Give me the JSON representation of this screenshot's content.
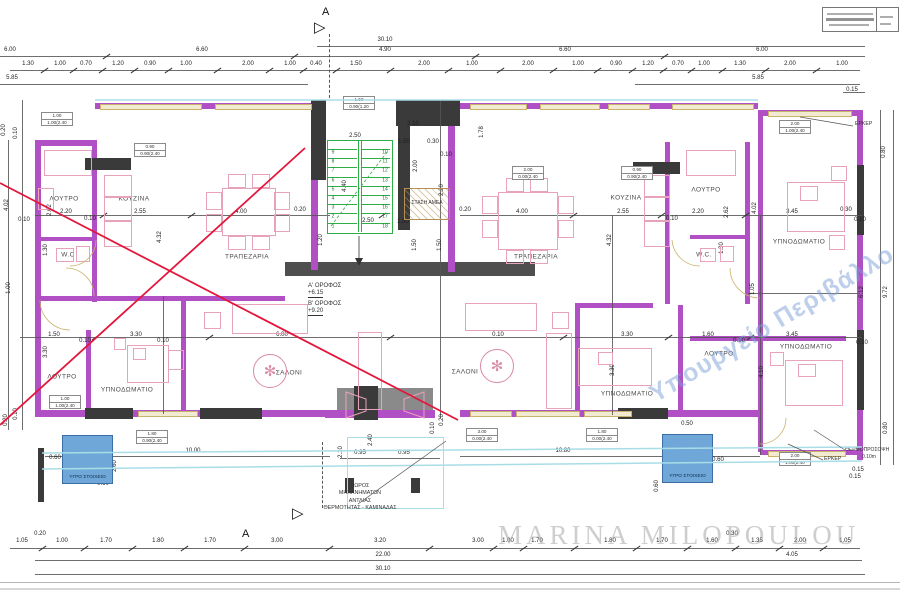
{
  "canvas": {
    "w": 900,
    "h": 600
  },
  "colors": {
    "wall": "#b050c4",
    "wall_dark": "#3a3a3a",
    "band": "#4f4f4f",
    "window": "#f3ead2",
    "window_edge": "#c9b269",
    "cyan": "#a8dde6",
    "dim": "#333333",
    "furn": "#e8a2ba",
    "stair": "#2fae47",
    "red": "#e3173c",
    "blue_fill": "#6fa8d8",
    "blue_edge": "#3b6ea5",
    "gray": "#8a8a8a",
    "hatch": "#b49055"
  },
  "header": {
    "section_letter": "A"
  },
  "watermark": {
    "text": "MARINA MILOPOULOU"
  },
  "stamp": {
    "text": "Υπουργείο Περιβάλλο"
  },
  "levels": {
    "l1": "Α' ΟΡΟΦΟΣ",
    "e1": "+6.15",
    "l2": "Β' ΟΡΟΦΟΣ",
    "e2": "+9.20"
  },
  "labels": {
    "wet": "ΥΓΡΟ ΣΤΟΙΧΕΙΟ",
    "amea": "ΣΤΑΣΗ ΑΜΕΑ",
    "erker": "ΕΡΚΕΡ",
    "thermo": "ΘΕΡΜΟΠΡΟΣΟΨΗ",
    "thermo_val": "0.10m",
    "m1": "ΧΩΡΟΣ",
    "m2": "ΜΗΧΑΝΗΜΑΤΩΝ",
    "m3": "ΑΝΤΛΙΑΣ",
    "m4": "ΘΕΡΜΟΤΗΤΑΣ - ΚΑΜΙΝΑΔΑΣ"
  },
  "rooms": [
    [
      "ΛΟΥΤΡΟ",
      64,
      199
    ],
    [
      "ΚΟΥΖΙΝΑ",
      134,
      199
    ],
    [
      "W.C",
      68,
      255
    ],
    [
      "ΤΡΑΠΕΖΑΡΙΑ",
      247,
      257
    ],
    [
      "ΛΟΥΤΡΟ",
      62,
      377
    ],
    [
      "ΥΠΝΟΔΩΜΑΤΙΟ",
      127,
      390
    ],
    [
      "ΣΑΛΟΝΙ",
      289,
      373
    ],
    [
      "ΣΑΛΟΝΙ",
      465,
      372
    ],
    [
      "ΤΡΑΠΕΖΑΡΙΑ",
      536,
      257
    ],
    [
      "ΚΟΥΖΙΝΑ",
      626,
      198
    ],
    [
      "ΛΟΥΤΡΟ",
      706,
      190
    ],
    [
      "W.C.",
      704,
      255
    ],
    [
      "ΥΠΝΟΔΩΜΑΤΙΟ",
      627,
      394
    ],
    [
      "ΛΟΥΤΡΟ",
      719,
      354
    ],
    [
      "ΥΠΝΟΔΩΜΑΤΙΟ",
      799,
      242
    ],
    [
      "ΥΠΝΟΔΩΜΑΤΙΟ",
      806,
      347
    ]
  ],
  "dims": [
    [
      "30.10",
      385,
      40
    ],
    [
      "6.00",
      10,
      50
    ],
    [
      "6.60",
      202,
      50
    ],
    [
      "4.90",
      385,
      50
    ],
    [
      "6.60",
      565,
      50
    ],
    [
      "6.00",
      762,
      50
    ],
    [
      "1.30",
      28,
      64
    ],
    [
      "1.00",
      60,
      64
    ],
    [
      "0.70",
      86,
      64
    ],
    [
      "1.20",
      118,
      64
    ],
    [
      "0.90",
      150,
      64
    ],
    [
      "1.00",
      186,
      64
    ],
    [
      "2.00",
      248,
      64
    ],
    [
      "1.00",
      290,
      64
    ],
    [
      "0.40",
      316,
      64
    ],
    [
      "1.50",
      356,
      64
    ],
    [
      "2.00",
      424,
      64
    ],
    [
      "1.00",
      472,
      64
    ],
    [
      "2.00",
      528,
      64
    ],
    [
      "1.00",
      578,
      64
    ],
    [
      "0.90",
      616,
      64
    ],
    [
      "1.20",
      648,
      64
    ],
    [
      "0.70",
      678,
      64
    ],
    [
      "1.00",
      704,
      64
    ],
    [
      "1.30",
      740,
      64
    ],
    [
      "2.00",
      790,
      64
    ],
    [
      "1.00",
      842,
      64
    ],
    [
      "5.85",
      12,
      78
    ],
    [
      "5.85",
      758,
      78
    ],
    [
      "0.15",
      852,
      90
    ],
    [
      "0.20",
      4,
      130,
      1
    ],
    [
      "0.10",
      16,
      133,
      1
    ],
    [
      "4.02",
      7,
      205,
      1
    ],
    [
      "2.62",
      50,
      210,
      1
    ],
    [
      "0.10",
      24,
      220
    ],
    [
      "1.30",
      46,
      250,
      1
    ],
    [
      "1.00",
      9,
      288,
      1
    ],
    [
      "3.30",
      46,
      352,
      1
    ],
    [
      "0.20",
      6,
      420,
      1
    ],
    [
      "0.10",
      16,
      414,
      1
    ],
    [
      "0.80",
      884,
      152,
      1
    ],
    [
      "6.12",
      862,
      292,
      1
    ],
    [
      "9.72",
      886,
      292,
      1
    ],
    [
      "0.80",
      886,
      428,
      1
    ],
    [
      "0.15",
      858,
      470
    ],
    [
      "2.20",
      66,
      212
    ],
    [
      "0.10",
      90,
      219
    ],
    [
      "2.55",
      140,
      212
    ],
    [
      "4.00",
      241,
      212
    ],
    [
      "0.20",
      300,
      210
    ],
    [
      "0.20",
      465,
      210
    ],
    [
      "4.00",
      522,
      212
    ],
    [
      "2.55",
      623,
      212
    ],
    [
      "0.10",
      672,
      219
    ],
    [
      "2.20",
      698,
      212
    ],
    [
      "3.45",
      792,
      212
    ],
    [
      "0.30",
      846,
      210
    ],
    [
      "0.10",
      860,
      220
    ],
    [
      "4.32",
      160,
      237,
      1
    ],
    [
      "4.32",
      610,
      240,
      1
    ],
    [
      "2.62",
      727,
      212,
      1
    ],
    [
      "4.02",
      755,
      208,
      1
    ],
    [
      "2.50",
      355,
      136
    ],
    [
      "2.10",
      413,
      124
    ],
    [
      "1.50",
      404,
      142
    ],
    [
      "0.30",
      433,
      142
    ],
    [
      "0.10",
      446,
      155
    ],
    [
      "1.78",
      482,
      132,
      1
    ],
    [
      "2.00",
      416,
      166,
      1
    ],
    [
      "2.20",
      442,
      190,
      1
    ],
    [
      "1.80",
      403,
      222
    ],
    [
      "1.50",
      415,
      245,
      1
    ],
    [
      "1.50",
      440,
      245,
      1
    ],
    [
      "2.50",
      368,
      221
    ],
    [
      "4.40",
      345,
      186,
      1
    ],
    [
      "1.20",
      321,
      240,
      1
    ],
    [
      "1.50",
      54,
      335
    ],
    [
      "0.10",
      85,
      341
    ],
    [
      "3.30",
      136,
      335
    ],
    [
      "0.10",
      163,
      341
    ],
    [
      "6.00",
      282,
      335
    ],
    [
      "0.10",
      498,
      335
    ],
    [
      "3.30",
      627,
      335
    ],
    [
      "1.60",
      708,
      335
    ],
    [
      "0.10",
      739,
      341
    ],
    [
      "3.45",
      792,
      335
    ],
    [
      "0.10",
      862,
      343
    ],
    [
      "3.30",
      613,
      370,
      1
    ],
    [
      "4.10",
      762,
      372,
      1
    ],
    [
      "1.05",
      753,
      289,
      1
    ],
    [
      "1.30",
      722,
      248,
      1
    ],
    [
      "10.00",
      193,
      451
    ],
    [
      "10.80",
      563,
      451
    ],
    [
      "0.95",
      360,
      453
    ],
    [
      "0.95",
      404,
      453
    ],
    [
      "2.10",
      341,
      452,
      1
    ],
    [
      "2.40",
      371,
      440,
      1
    ],
    [
      "0.60",
      55,
      458
    ],
    [
      "2.60",
      115,
      466,
      1
    ],
    [
      "0.60",
      103,
      484
    ],
    [
      "0.50",
      687,
      424
    ],
    [
      "0.60",
      718,
      460
    ],
    [
      "0.60",
      657,
      486,
      1
    ],
    [
      "3.90",
      788,
      465
    ],
    [
      "0.15",
      855,
      477
    ],
    [
      "0.10",
      433,
      428,
      1
    ],
    [
      "0.20",
      442,
      420,
      1
    ],
    [
      "1.05",
      22,
      541
    ],
    [
      "0.20",
      40,
      534
    ],
    [
      "1.00",
      62,
      541
    ],
    [
      "1.70",
      106,
      541
    ],
    [
      "1.80",
      158,
      541
    ],
    [
      "1.70",
      210,
      541
    ],
    [
      "3.00",
      277,
      541
    ],
    [
      "3.20",
      380,
      541
    ],
    [
      "3.00",
      478,
      541
    ],
    [
      "1.00",
      508,
      541
    ],
    [
      "1.70",
      537,
      541
    ],
    [
      "1.80",
      610,
      541
    ],
    [
      "1.70",
      662,
      541
    ],
    [
      "1.60",
      712,
      541
    ],
    [
      "0.30",
      732,
      534
    ],
    [
      "1.35",
      757,
      541
    ],
    [
      "2.00",
      800,
      541
    ],
    [
      "1.05",
      845,
      541
    ],
    [
      "22.00",
      383,
      555
    ],
    [
      "4.05",
      792,
      555
    ],
    [
      "30.10",
      383,
      569
    ]
  ],
  "tick_rows": [
    {
      "label_y": 50,
      "line_y": 56
    },
    {
      "label_y": 64,
      "line_y": 70
    },
    {
      "label_y": 541,
      "line_y": 548
    },
    {
      "label_y": 212,
      "line_y": 215
    },
    {
      "label_y": 335,
      "line_y": 337
    }
  ],
  "schedule_boxes": [
    [
      57,
      112,
      "1.00",
      "1.00(2.40"
    ],
    [
      150,
      143,
      "0.90",
      "0.90(2.40"
    ],
    [
      359,
      96,
      "1.50",
      "0.90(1.20"
    ],
    [
      528,
      166,
      "2.00",
      "0.00(2.40"
    ],
    [
      637,
      166,
      "0.90",
      "0.90(2.40"
    ],
    [
      795,
      120,
      "2.00",
      "1.00(2.40"
    ],
    [
      65,
      395,
      "1.00",
      "1.00(2.40"
    ],
    [
      152,
      430,
      "1.80",
      "0.90(2.40"
    ],
    [
      482,
      428,
      "3.00",
      "0.00(2.40"
    ],
    [
      602,
      428,
      "1.80",
      "0.00(2.40"
    ],
    [
      795,
      452,
      "2.00",
      "1.00(2.40"
    ]
  ],
  "stairs": {
    "x": 327,
    "y": 140,
    "w": 64,
    "h": 92,
    "left": [
      "9",
      "8",
      "7",
      "6",
      "5",
      "4",
      "3",
      "2",
      "1"
    ],
    "right": [
      "10",
      "11",
      "12",
      "13",
      "14",
      "15",
      "16",
      "17",
      "18"
    ]
  },
  "plan": {
    "walls": [
      [
        95,
        103,
        230,
        6
      ],
      [
        430,
        103,
        328,
        6
      ],
      [
        758,
        110,
        102,
        6
      ],
      [
        35,
        140,
        6,
        277
      ],
      [
        35,
        140,
        62,
        6
      ],
      [
        857,
        110,
        6,
        350
      ],
      [
        35,
        410,
        296,
        7
      ],
      [
        460,
        410,
        300,
        7
      ],
      [
        760,
        450,
        100,
        5
      ],
      [
        92,
        142,
        5,
        160
      ],
      [
        35,
        296,
        250,
        5
      ],
      [
        86,
        330,
        5,
        82
      ],
      [
        181,
        300,
        5,
        112
      ],
      [
        665,
        142,
        5,
        162
      ],
      [
        745,
        142,
        5,
        162
      ],
      [
        758,
        116,
        5,
        336
      ],
      [
        690,
        235,
        56,
        4
      ],
      [
        35,
        237,
        58,
        4
      ],
      [
        575,
        303,
        78,
        5
      ],
      [
        575,
        303,
        5,
        110
      ],
      [
        678,
        305,
        5,
        108
      ],
      [
        690,
        336,
        156,
        5
      ],
      [
        448,
        126,
        7,
        146
      ],
      [
        311,
        178,
        7,
        92
      ],
      [
        325,
        410,
        110,
        8
      ]
    ],
    "black": [
      [
        311,
        100,
        15,
        80
      ],
      [
        396,
        100,
        64,
        26
      ],
      [
        398,
        126,
        12,
        104
      ],
      [
        85,
        158,
        46,
        12
      ],
      [
        633,
        162,
        47,
        12
      ],
      [
        85,
        408,
        48,
        11
      ],
      [
        200,
        408,
        62,
        11
      ],
      [
        618,
        408,
        50,
        11
      ],
      [
        345,
        478,
        9,
        15
      ],
      [
        411,
        478,
        9,
        15
      ],
      [
        38,
        448,
        6,
        54
      ],
      [
        354,
        386,
        24,
        34
      ],
      [
        857,
        165,
        7,
        70
      ],
      [
        857,
        330,
        7,
        80
      ]
    ],
    "lift": [
      337,
      388,
      96,
      30
    ],
    "band": [
      [
        285,
        262,
        250,
        14
      ]
    ],
    "windows": [
      [
        100,
        104,
        100,
        4
      ],
      [
        215,
        104,
        95,
        4
      ],
      [
        470,
        104,
        55,
        4
      ],
      [
        540,
        104,
        58,
        4
      ],
      [
        608,
        104,
        40,
        4
      ],
      [
        672,
        104,
        80,
        4
      ],
      [
        768,
        111,
        82,
        4
      ],
      [
        138,
        411,
        58,
        4
      ],
      [
        470,
        411,
        40,
        4
      ],
      [
        516,
        411,
        62,
        4
      ],
      [
        584,
        411,
        46,
        4
      ],
      [
        768,
        451,
        76,
        4
      ]
    ],
    "dlines": [
      [
        317,
        46,
        548,
        1
      ],
      [
        0,
        56,
        865,
        1
      ],
      [
        10,
        70,
        850,
        1
      ],
      [
        0,
        84,
        308,
        1
      ],
      [
        635,
        84,
        225,
        1
      ],
      [
        843,
        92,
        22,
        1
      ],
      [
        35,
        215,
        295,
        1
      ],
      [
        460,
        215,
        402,
        1
      ],
      [
        20,
        337,
        842,
        1
      ],
      [
        748,
        293,
        112,
        1
      ],
      [
        10,
        548,
        850,
        1
      ],
      [
        35,
        560,
        715,
        1
      ],
      [
        750,
        560,
        112,
        1
      ],
      [
        35,
        574,
        830,
        1
      ],
      [
        45,
        456,
        285,
        1
      ],
      [
        460,
        456,
        300,
        1
      ],
      [
        340,
        458,
        100,
        1
      ],
      [
        8,
        140,
        1,
        290
      ],
      [
        22,
        100,
        1,
        330
      ],
      [
        880,
        110,
        1,
        355
      ],
      [
        893,
        110,
        1,
        355
      ],
      [
        163,
        296,
        1,
        118
      ],
      [
        440,
        100,
        1,
        318
      ],
      [
        612,
        215,
        1,
        200
      ],
      [
        760,
        215,
        1,
        240
      ],
      [
        0,
        582,
        900,
        1,
        "#aaaaaa"
      ],
      [
        0,
        588,
        900,
        2,
        "#d0d0d0"
      ]
    ],
    "furn": [
      [
        44,
        150,
        46,
        24
      ],
      [
        38,
        188,
        14,
        20
      ],
      [
        104,
        175,
        26,
        20
      ],
      [
        104,
        197,
        26,
        22
      ],
      [
        104,
        221,
        26,
        24
      ],
      [
        56,
        248,
        16,
        12
      ],
      [
        76,
        246,
        12,
        14
      ],
      [
        222,
        188,
        52,
        46
      ],
      [
        206,
        192,
        14,
        16
      ],
      [
        206,
        214,
        14,
        16
      ],
      [
        274,
        192,
        14,
        16
      ],
      [
        274,
        214,
        14,
        16
      ],
      [
        228,
        174,
        16,
        12
      ],
      [
        252,
        174,
        16,
        12
      ],
      [
        228,
        236,
        16,
        12
      ],
      [
        252,
        236,
        16,
        12
      ],
      [
        232,
        304,
        74,
        28
      ],
      [
        358,
        332,
        22,
        76
      ],
      [
        204,
        312,
        15,
        15
      ],
      [
        127,
        345,
        40,
        36
      ],
      [
        114,
        338,
        10,
        10
      ],
      [
        168,
        350,
        14,
        18
      ],
      [
        700,
        248,
        14,
        12
      ],
      [
        720,
        246,
        12,
        14
      ],
      [
        644,
        175,
        24,
        20
      ],
      [
        644,
        197,
        24,
        22
      ],
      [
        644,
        221,
        24,
        24
      ],
      [
        686,
        150,
        48,
        24
      ],
      [
        498,
        192,
        58,
        56
      ],
      [
        482,
        196,
        14,
        16
      ],
      [
        482,
        220,
        14,
        16
      ],
      [
        558,
        196,
        14,
        16
      ],
      [
        558,
        220,
        14,
        16
      ],
      [
        506,
        178,
        16,
        12
      ],
      [
        530,
        178,
        16,
        12
      ],
      [
        506,
        250,
        16,
        12
      ],
      [
        530,
        250,
        16,
        12
      ],
      [
        465,
        303,
        70,
        26
      ],
      [
        546,
        333,
        24,
        74
      ],
      [
        552,
        312,
        15,
        15
      ],
      [
        578,
        348,
        72,
        36
      ],
      [
        787,
        182,
        56,
        48
      ],
      [
        785,
        360,
        56,
        44
      ],
      [
        831,
        166,
        14,
        13
      ],
      [
        829,
        235,
        14,
        13
      ],
      [
        770,
        352,
        12,
        12
      ],
      [
        800,
        186,
        16,
        13
      ],
      [
        133,
        348,
        11,
        10
      ],
      [
        598,
        352,
        13,
        11
      ],
      [
        798,
        364,
        16,
        11
      ]
    ],
    "plants": [
      [
        270,
        371
      ],
      [
        497,
        366
      ]
    ]
  },
  "svg": {
    "red": [
      [
        0,
        183,
        458,
        420
      ],
      [
        0,
        425,
        305,
        148
      ]
    ],
    "cyan": [
      [
        95,
        100,
        758,
        100
      ],
      [
        42,
        453,
        862,
        447
      ],
      [
        42,
        469,
        862,
        461
      ]
    ],
    "leaders": [
      [
        358,
        504,
        446,
        441
      ],
      [
        800,
        117,
        853,
        126
      ],
      [
        814,
        430,
        845,
        450
      ],
      [
        788,
        444,
        823,
        460
      ]
    ],
    "green_diag": [
      [
        331,
        226,
        387,
        152
      ]
    ],
    "arcs": [
      "M66,268 A28,28 0 0 1 94,296",
      "M96,240 A26,26 0 0 1 70,266",
      "M700,266 A28,28 0 0 1 672,240",
      "M760,298 A30,30 0 0 1 730,268",
      "M40,300 A30,30 0 0 0 70,330",
      "M786,418 A26,26 0 0 1 760,444"
    ],
    "lift": [
      "346,392 366,399 366,411 346,418",
      "424,392 404,399 404,411 424,418"
    ],
    "arrow_line": [
      359,
      236,
      359,
      260
    ],
    "arrow_head": "355,258 363,258 359,266"
  }
}
